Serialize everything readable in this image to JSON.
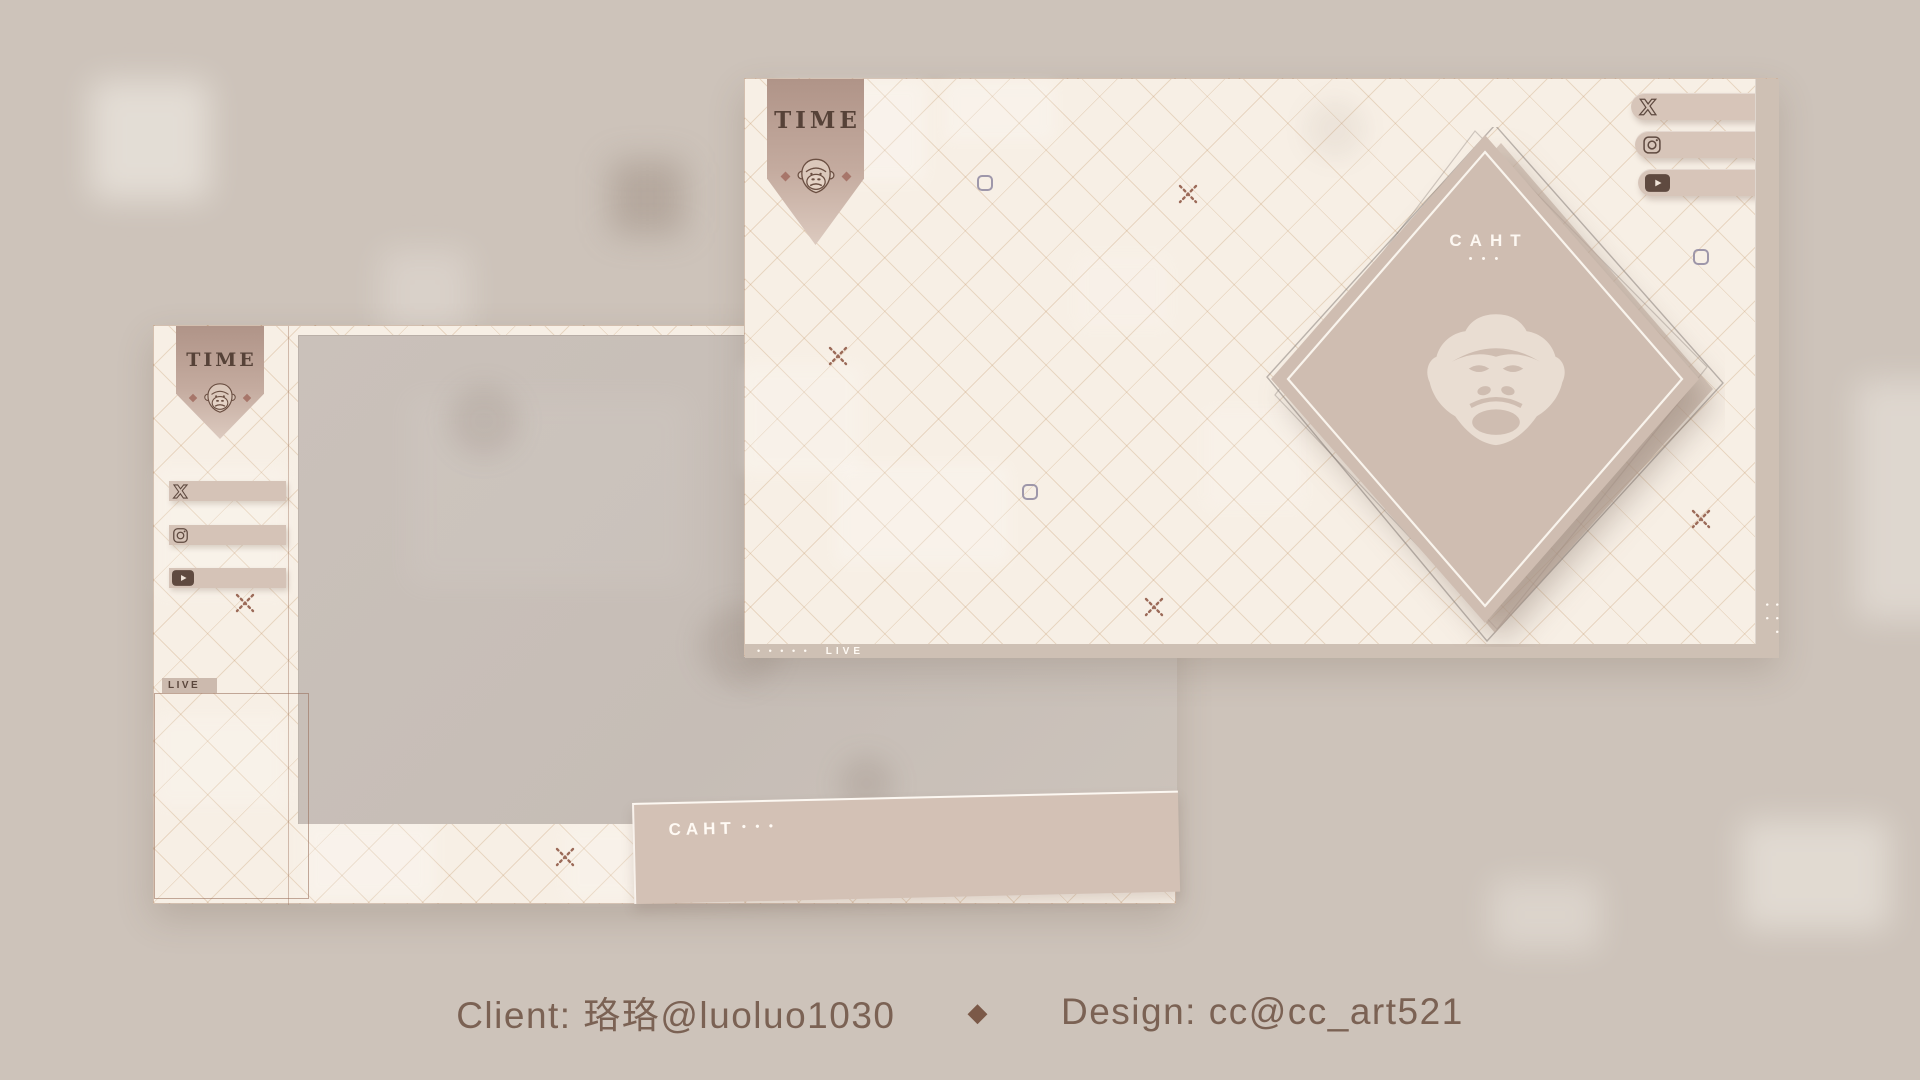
{
  "footer": {
    "client": "Client: 珞珞@luoluo1030",
    "separator": "◆",
    "design": "Design: cc@cc_art521"
  },
  "scene_large": {
    "banner_title": "TIME",
    "diamond": {
      "title": "CAHT",
      "dots": "• • •"
    },
    "live_bar": {
      "dots": "• • • • •",
      "label": "LIVE"
    },
    "strip_dots": "• • • • •",
    "social": [
      {
        "name": "x"
      },
      {
        "name": "instagram"
      },
      {
        "name": "youtube"
      }
    ]
  },
  "scene_small": {
    "banner_title": "TIME",
    "live_tab_label": "LIVE",
    "chat_bar": {
      "title": "CAHT",
      "dots": "• • •"
    },
    "social": [
      {
        "name": "x"
      },
      {
        "name": "instagram"
      },
      {
        "name": "youtube"
      }
    ]
  },
  "colors": {
    "backdrop": "#cdc3ba",
    "scene_cream": "#f7efe5",
    "grid_line": "#c79c70",
    "panel_tan": "#cfbdb1",
    "pill_tan": "#d7c5b9",
    "dark_brown": "#5f4a40",
    "text_brown": "#7b6254",
    "white_text": "#fdf8f2",
    "pixel_square_blue": "#8e87a0",
    "x_mark_brown": "#9b6a58"
  }
}
